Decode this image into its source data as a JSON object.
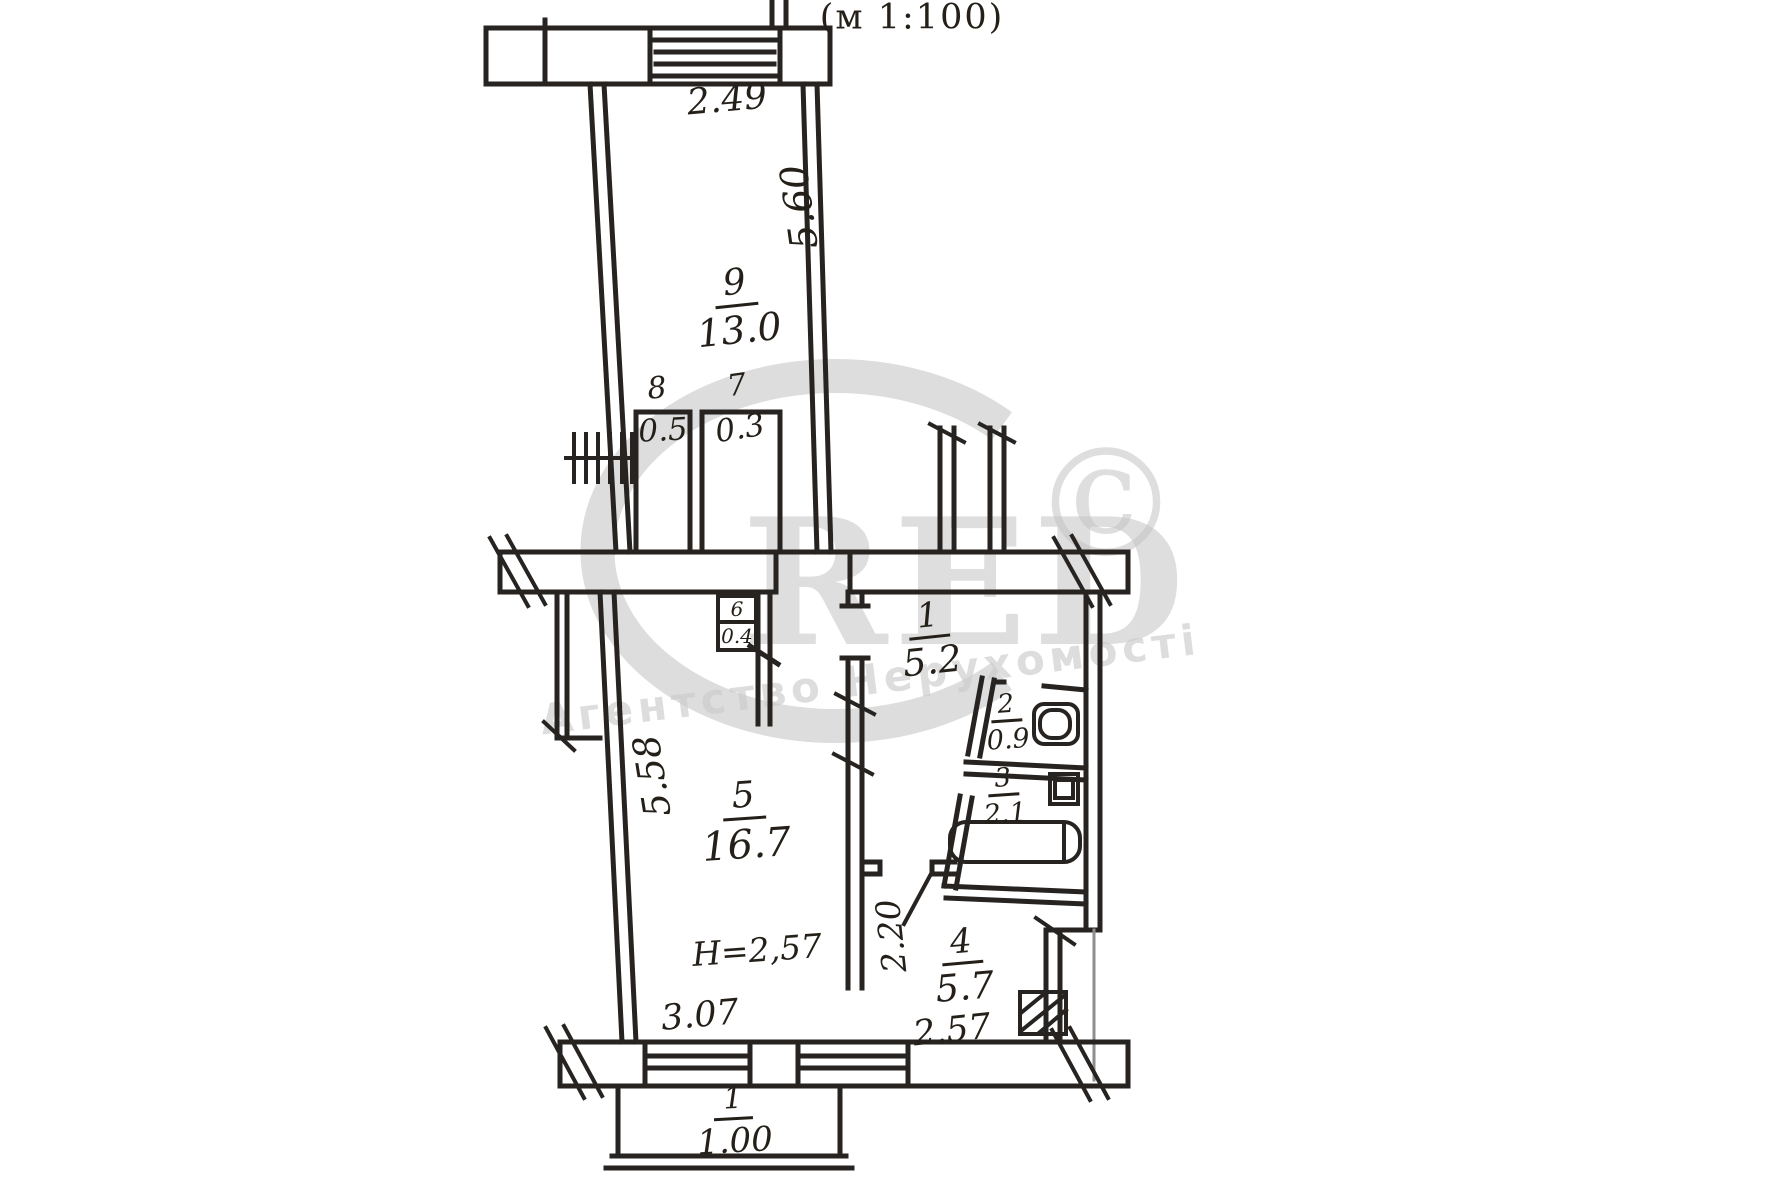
{
  "scale_note": "(м 1:100)",
  "watermark": {
    "letters": "RED",
    "copyright": "©",
    "subtitle": "Агентство Нерухомості"
  },
  "rooms": {
    "room9": {
      "number": "9",
      "area": "13.0"
    },
    "closet8": {
      "number": "8",
      "area": "0.5"
    },
    "closet7": {
      "number": "7",
      "area": "0.3"
    },
    "closet6": {
      "number": "6",
      "area": "0.4"
    },
    "hall1": {
      "number": "1",
      "area": "5.2"
    },
    "wc2": {
      "number": "2",
      "area": "0.9"
    },
    "bath3": {
      "number": "3",
      "area": "2.1"
    },
    "living5": {
      "number": "5",
      "area": "16.7",
      "ceiling_height": "Н=2,57"
    },
    "kitchen4": {
      "number": "4",
      "area": "5.7"
    },
    "balcony": {
      "number": "1",
      "area": "1.00"
    }
  },
  "dimensions": {
    "room9_width": "2.49",
    "room9_depth": "5.60",
    "living5_depth": "5.58",
    "living5_width": "3.07",
    "kitchen_width": "2.57",
    "kitchen_depth": "2.20"
  }
}
